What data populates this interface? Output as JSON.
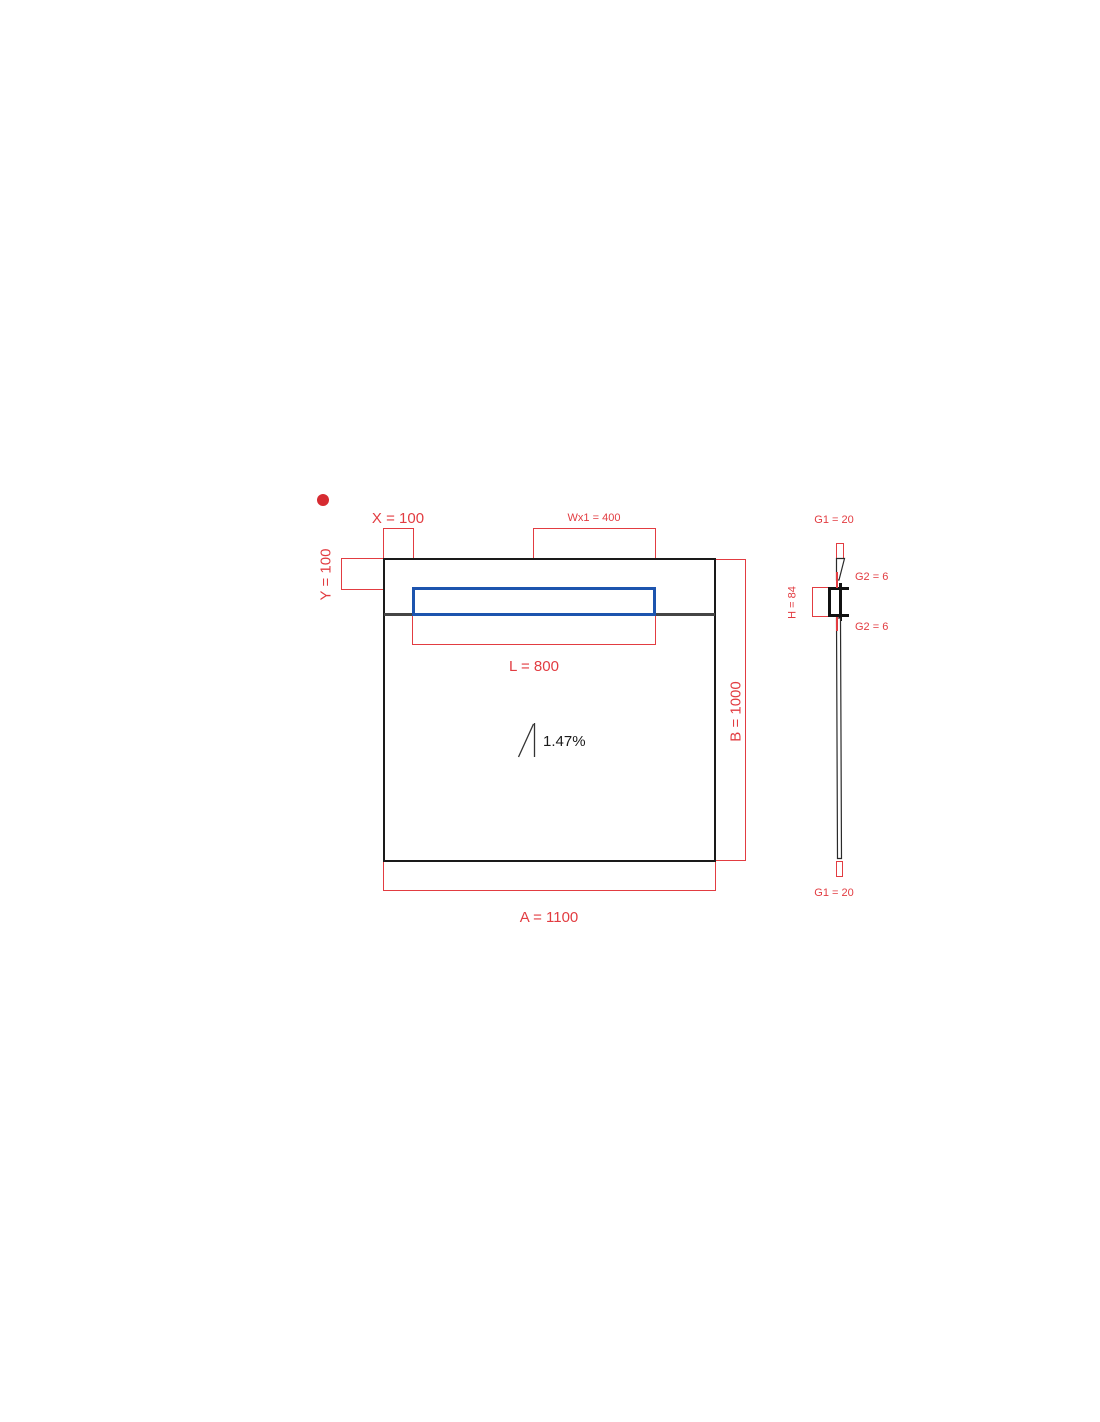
{
  "colors": {
    "dimension_red": "#e23c41",
    "marker_red": "#d62b31",
    "channel_blue": "#1d54ae",
    "line_black": "#1a1a1a",
    "waterline_gray": "#454545",
    "slope_text": "#1a1a1a"
  },
  "plan_view": {
    "dim_x_label": "X = 100",
    "dim_wx1_label": "Wx1 = 400",
    "dim_y_label": "Y = 100",
    "dim_l_label": "L = 800",
    "dim_b_label": "B = 1000",
    "dim_a_label": "A = 1100",
    "slope_label": "1.47%"
  },
  "profile_view": {
    "dim_g1_top_label": "G1 = 20",
    "dim_g2_top_label": "G2 = 6",
    "dim_h_label": "H = 84",
    "dim_g2_bottom_label": "G2 = 6",
    "dim_g1_bottom_label": "G1 = 20"
  }
}
